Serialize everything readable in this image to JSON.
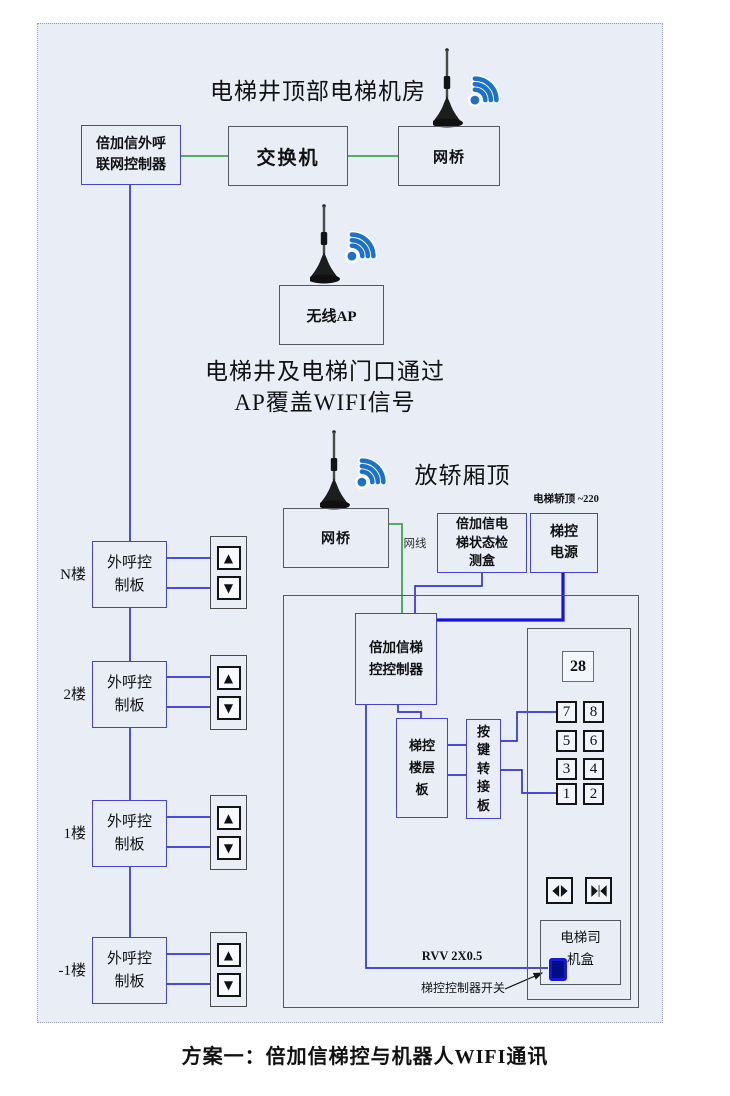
{
  "colors": {
    "background": "#e8edf6",
    "wire_blue": "#3434cf",
    "wire_blue_thick": "#1414dc",
    "wire_green": "#3fa54f",
    "box_blue_border": "#4444cf",
    "box_grey_border": "#55585f",
    "wifi_blue": "#1b72c8",
    "switch_blue": "#1717d8"
  },
  "machine_room": {
    "title": "电梯井顶部电梯机房",
    "net_controller": [
      "倍加信外呼",
      "联网控制器"
    ],
    "switch": "交换机",
    "bridge": "网桥"
  },
  "shaft": {
    "ap_box": "无线AP",
    "note_line1": "电梯井及电梯门口通过",
    "note_line2": "AP覆盖WIFI信号"
  },
  "cartop": {
    "title": "放轿厢顶",
    "power_note": "电梯轿顶 ~220",
    "bridge": "网桥",
    "cable_label": "网线",
    "detect_box": [
      "倍加信电",
      "梯状态检",
      "测盒"
    ],
    "power_box": [
      "梯控",
      "电源"
    ],
    "controller": [
      "倍加信梯",
      "控控制器"
    ],
    "floor_board": [
      "梯控",
      "楼层",
      "板"
    ],
    "key_adapter": [
      "按",
      "键",
      "转",
      "接",
      "板"
    ],
    "rvv_label": "RVV 2X0.5",
    "switch_label": "梯控控制器开关"
  },
  "car_panel": {
    "display": "28",
    "buttons": [
      "7",
      "8",
      "5",
      "6",
      "3",
      "4",
      "1",
      "2"
    ],
    "driver_box": [
      "电梯司",
      "机盒"
    ]
  },
  "floors": {
    "board": [
      "外呼控",
      "制板"
    ],
    "items": [
      {
        "label": "N楼"
      },
      {
        "label": "2楼"
      },
      {
        "label": "1楼"
      },
      {
        "label": "-1楼"
      }
    ]
  },
  "icons": {
    "up_arrow": "▲",
    "down_arrow": "▼"
  },
  "caption": "方案一：倍加信梯控与机器人WIFI通讯"
}
